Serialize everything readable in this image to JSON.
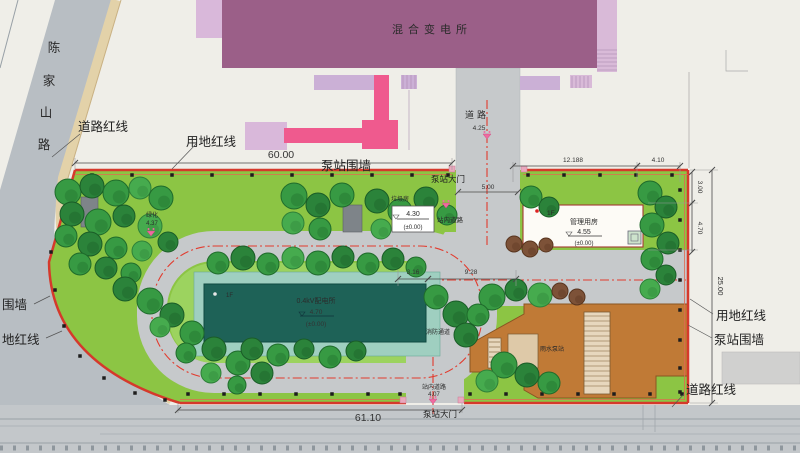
{
  "colors": {
    "redline": "#d5392b",
    "site_green": "#8cc544",
    "inner_green": "#9cd35f",
    "building_teal": "#1e6257",
    "building_orange": "#c07a36",
    "substation_purple": "#9b5f88",
    "accent_pink": "#ef5a8e"
  },
  "plan": {
    "substation_label": "混合变电所",
    "left_road_chars": [
      "陈",
      "家",
      "山",
      "路"
    ],
    "top_road": {
      "label": "道路",
      "elev": "4.25"
    },
    "callouts": {
      "road_redline_topleft": "道路红线",
      "land_redline_top": "用地红线",
      "wall_top": "泵站围墙",
      "gate_top": "泵站大门",
      "gate_bottom": "泵站大门",
      "wall_left": "围墙",
      "land_redline_left": "地红线",
      "land_redline_right": "用地红线",
      "wall_right": "泵站围墙",
      "road_redline_right": "道路红线",
      "fire_lane": "消防通道",
      "trash_room": "垃圾房"
    },
    "dims": {
      "top_width": "60.00",
      "bottom_width": "61.10",
      "gate_top": "5.00",
      "mgmt_a": "12.188",
      "mgmt_b": "4.10",
      "right_a": "3.00",
      "right_b": "4.70",
      "site_depth": "25.00",
      "plaza_a": "3.16",
      "plaza_b": "9.28"
    },
    "spots": {
      "internal_top": {
        "label": "站内道路",
        "elev": "4.30",
        "datum": "(±0.00)"
      },
      "internal_bottom": {
        "label": "站内道路",
        "elev": "4.07"
      },
      "greening": {
        "label": "绿化",
        "elev": "4.37"
      }
    },
    "buildings": {
      "distribution": {
        "floor": "1F",
        "name": "0.4kV配电所",
        "elev": "4.70",
        "datum": "(±0.00)"
      },
      "management": {
        "floor": "1F",
        "name": "管理用房",
        "elev": "4.55",
        "datum": "(±0.00)"
      },
      "rain_pump": {
        "name": "雨水泵站"
      }
    }
  }
}
